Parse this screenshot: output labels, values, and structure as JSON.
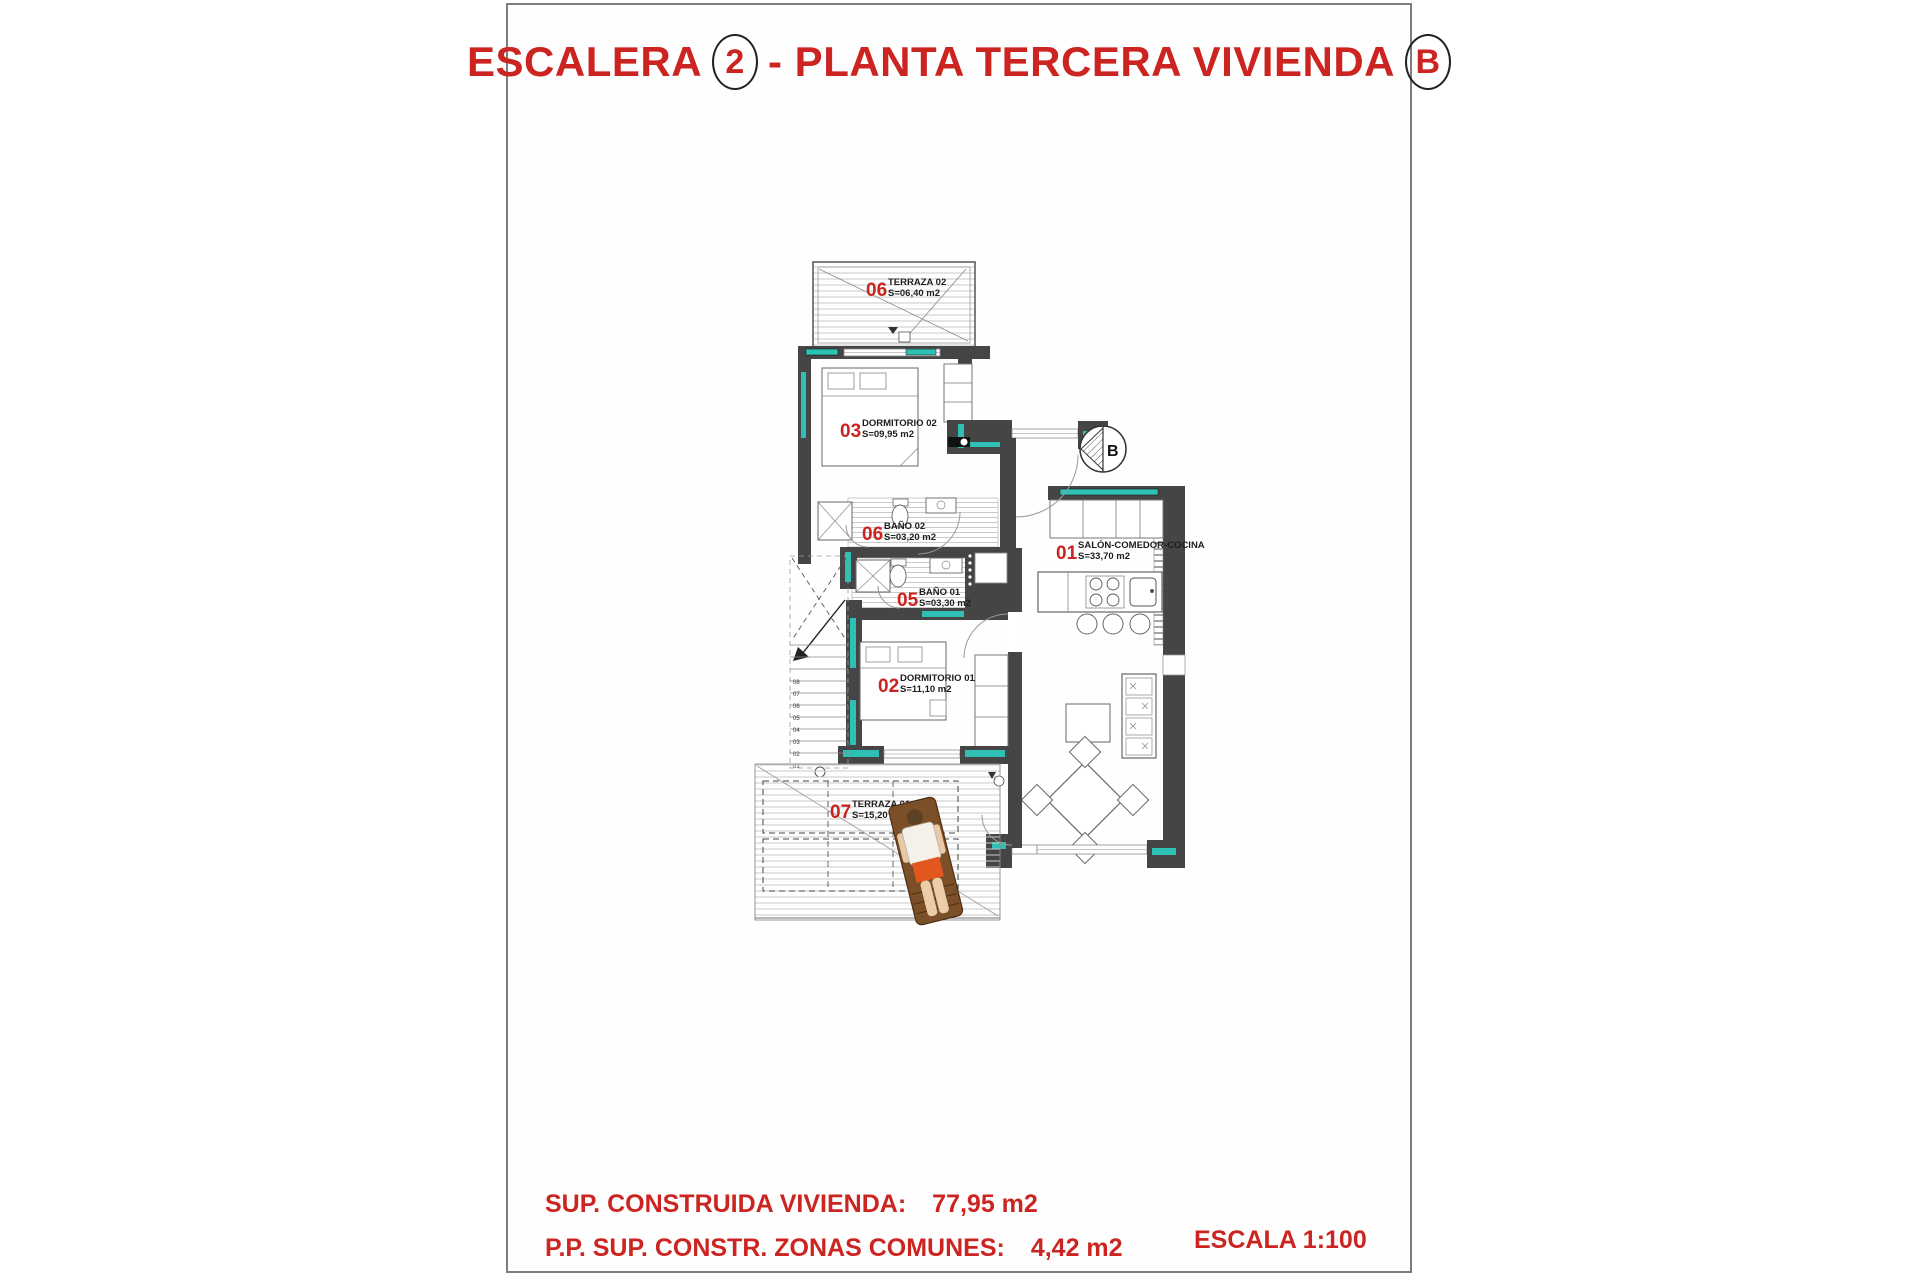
{
  "title": {
    "prefix": "ESCALERA",
    "stair_number": "2",
    "middle": "- PLANTA TERCERA VIVIENDA",
    "unit_letter": "B"
  },
  "colors": {
    "accent_red": "#cc2420",
    "wall_dark": "#454545",
    "insulation_teal": "#2ec0b4"
  },
  "rooms": [
    {
      "number": "06",
      "name": "TERRAZA 02",
      "area": "S=06,40 m2"
    },
    {
      "number": "03",
      "name": "DORMITORIO 02",
      "area": "S=09,95 m2"
    },
    {
      "number": "06",
      "name": "BAÑO 02",
      "area": "S=03,20 m2"
    },
    {
      "number": "01",
      "name": "SALÓN-COMEDOR-COCINA",
      "area": "S=33,70 m2"
    },
    {
      "number": "05",
      "name": "BAÑO 01",
      "area": "S=03,30 m2"
    },
    {
      "number": "02",
      "name": "DORMITORIO 01",
      "area": "S=11,10 m2"
    },
    {
      "number": "07",
      "name": "TERRAZA 01",
      "area": "S=15,20 m2"
    }
  ],
  "compass": {
    "letter": "B"
  },
  "stairs": {
    "steps": [
      "01",
      "02",
      "03",
      "04",
      "05",
      "06",
      "07",
      "08"
    ]
  },
  "footer": {
    "line1_label": "SUP. CONSTRUIDA VIVIENDA:",
    "line1_value": "77,95 m2",
    "line2_label": "P.P. SUP. CONSTR. ZONAS COMUNES:",
    "line2_value": "4,42 m2",
    "scale": "ESCALA 1:100"
  }
}
